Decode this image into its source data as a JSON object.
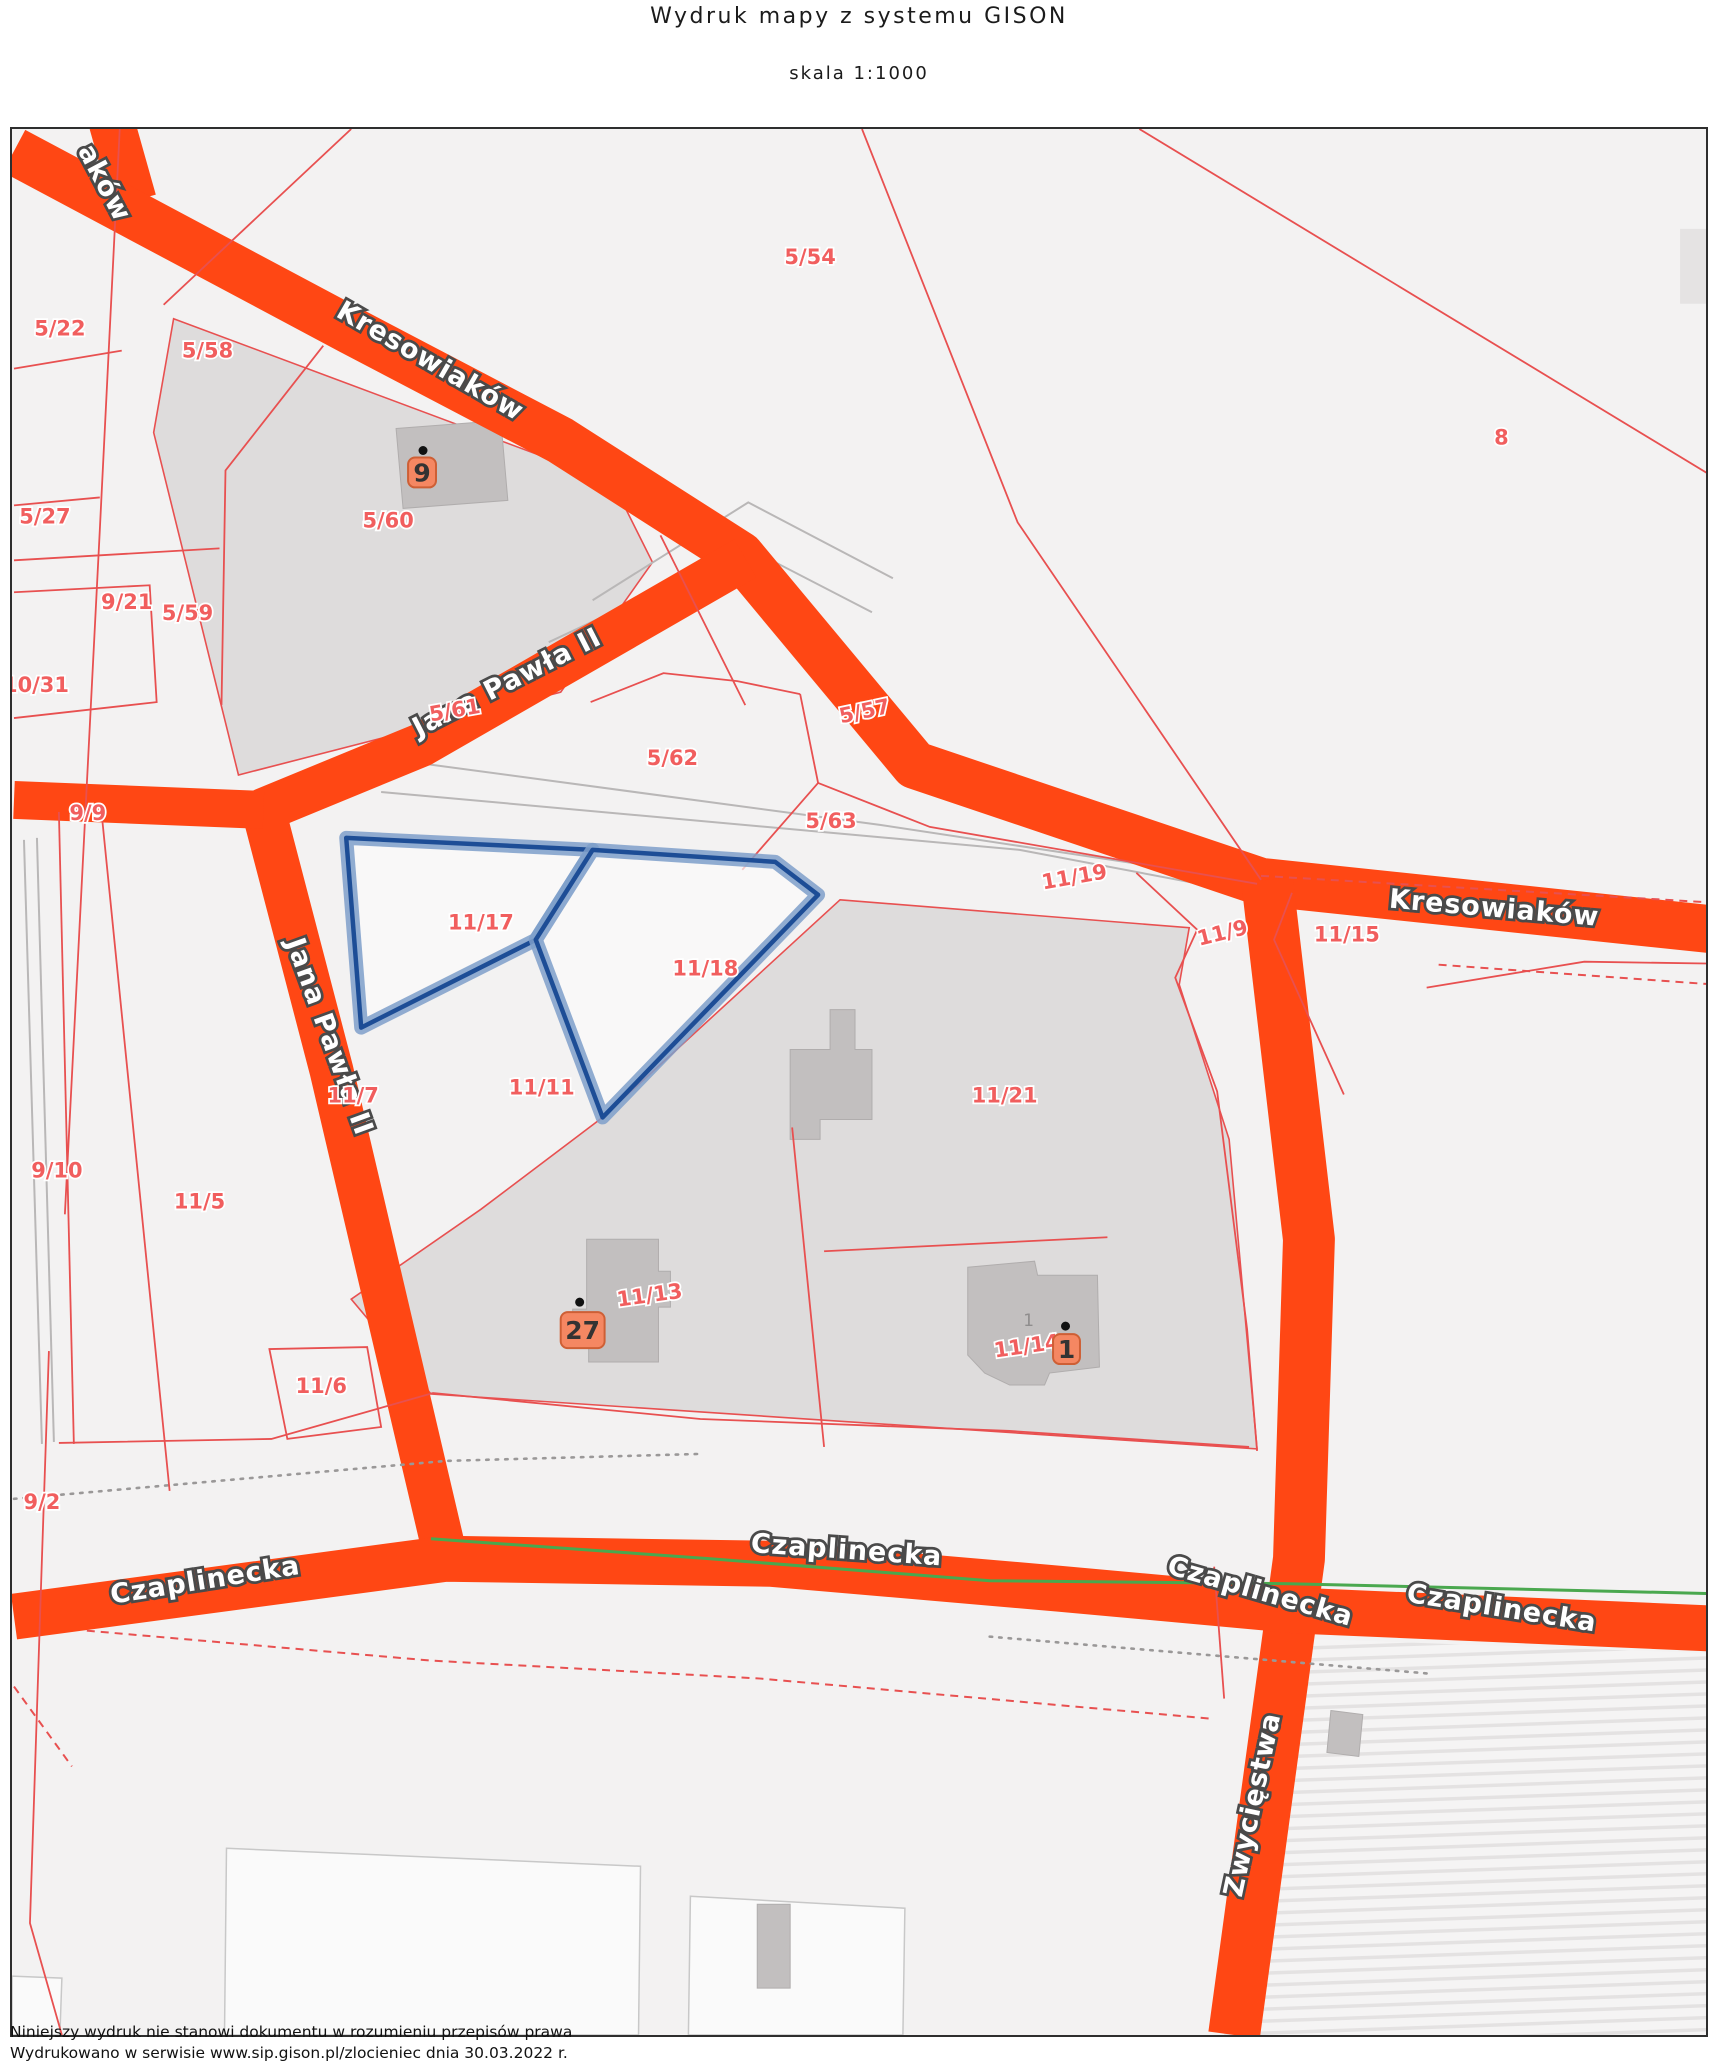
{
  "header": {
    "title": "Wydruk mapy z systemu GISON",
    "scale": "skala 1:1000"
  },
  "footer": {
    "line1": "Niniejszy wydruk nie stanowi dokumentu w rozumieniu przepisów prawa",
    "line2": "Wydrukowano w serwisie www.sip.gison.pl/zlocieniec dnia 30.03.2022 r."
  },
  "map": {
    "selected_parcels": [
      "11/17",
      "11/18"
    ],
    "streets": [
      {
        "name": "aków",
        "x": 85,
        "y": 58,
        "rot": 62
      },
      {
        "name": "Kresowiaków",
        "x": 415,
        "y": 240,
        "rot": 30
      },
      {
        "name": "Jana Pawła II",
        "x": 500,
        "y": 562,
        "rot": -27
      },
      {
        "name": "Jana Pawła II",
        "x": 310,
        "y": 912,
        "rot": 70
      },
      {
        "name": "Kresowiaków",
        "x": 1485,
        "y": 789,
        "rot": 5
      },
      {
        "name": "Czaplinecka",
        "x": 195,
        "y": 1462,
        "rot": -9
      },
      {
        "name": "Czaplinecka",
        "x": 836,
        "y": 1432,
        "rot": 4
      },
      {
        "name": "Czaplinecka",
        "x": 1249,
        "y": 1473,
        "rot": 16
      },
      {
        "name": "Czaplinecka",
        "x": 1492,
        "y": 1490,
        "rot": 9
      },
      {
        "name": "Zwycięstwa",
        "x": 1252,
        "y": 1680,
        "rot": -78
      }
    ],
    "parcels": [
      {
        "id": "5/22",
        "x": 48,
        "y": 207,
        "rot": 0
      },
      {
        "id": "5/58",
        "x": 196,
        "y": 229,
        "rot": 0
      },
      {
        "id": "5/27",
        "x": 33,
        "y": 395,
        "rot": 0
      },
      {
        "id": "9/21",
        "x": 115,
        "y": 481,
        "rot": 0
      },
      {
        "id": "5/59",
        "x": 176,
        "y": 492,
        "rot": 0
      },
      {
        "id": "10/31",
        "x": 24,
        "y": 564,
        "rot": 0
      },
      {
        "id": "5/60",
        "x": 377,
        "y": 399,
        "rot": 0
      },
      {
        "id": "5/54",
        "x": 800,
        "y": 135,
        "rot": 0
      },
      {
        "id": "8",
        "x": 1493,
        "y": 316,
        "rot": 0
      },
      {
        "id": "5/61",
        "x": 445,
        "y": 589,
        "rot": -10
      },
      {
        "id": "5/62",
        "x": 662,
        "y": 637,
        "rot": 0
      },
      {
        "id": "5/63",
        "x": 821,
        "y": 700,
        "rot": 0
      },
      {
        "id": "5/57",
        "x": 856,
        "y": 590,
        "rot": -12
      },
      {
        "id": "9/9",
        "x": 76,
        "y": 692,
        "rot": 0
      },
      {
        "id": "11/19",
        "x": 1066,
        "y": 756,
        "rot": -10
      },
      {
        "id": "11/17",
        "x": 470,
        "y": 802,
        "rot": 0
      },
      {
        "id": "11/18",
        "x": 695,
        "y": 848,
        "rot": 0
      },
      {
        "id": "11/9",
        "x": 1215,
        "y": 812,
        "rot": -14
      },
      {
        "id": "11/15",
        "x": 1338,
        "y": 814,
        "rot": 0
      },
      {
        "id": "11/21",
        "x": 995,
        "y": 975,
        "rot": 0
      },
      {
        "id": "11/7",
        "x": 342,
        "y": 975,
        "rot": 0
      },
      {
        "id": "11/11",
        "x": 531,
        "y": 967,
        "rot": 0
      },
      {
        "id": "9/10",
        "x": 45,
        "y": 1050,
        "rot": 0
      },
      {
        "id": "11/5",
        "x": 188,
        "y": 1081,
        "rot": 0
      },
      {
        "id": "11/6",
        "x": 310,
        "y": 1266,
        "rot": 0
      },
      {
        "id": "9/2",
        "x": 30,
        "y": 1382,
        "rot": 0
      },
      {
        "id": "11/13",
        "x": 640,
        "y": 1175,
        "rot": -8
      },
      {
        "id": "11/14",
        "x": 1018,
        "y": 1226,
        "rot": -8
      }
    ],
    "badges": [
      {
        "number": "9",
        "x": 411,
        "y": 344,
        "w": 28,
        "h": 30,
        "dot_dx": 1,
        "dot_dy": -21
      },
      {
        "number": "27",
        "x": 572,
        "y": 1203,
        "w": 44,
        "h": 36,
        "dot_dx": -3,
        "dot_dy": -24
      },
      {
        "number": "1",
        "x": 1057,
        "y": 1222,
        "w": 27,
        "h": 30,
        "dot_dx": -1,
        "dot_dy": -22
      }
    ],
    "building_number": {
      "text": "1",
      "x": 1019,
      "y": 1199
    },
    "colors": {
      "road": "#ff4714",
      "boundary": "#e85050",
      "parcel_label": "#f15e5e",
      "highlight_core": "#1d4d96",
      "highlight_glow": "#7e9fca",
      "badge_bg": "#f58762",
      "badge_border": "#ce5f35",
      "green_line": "#4aa84f",
      "gray_area": "#dedcdc",
      "building": "#c2bfbf"
    }
  }
}
